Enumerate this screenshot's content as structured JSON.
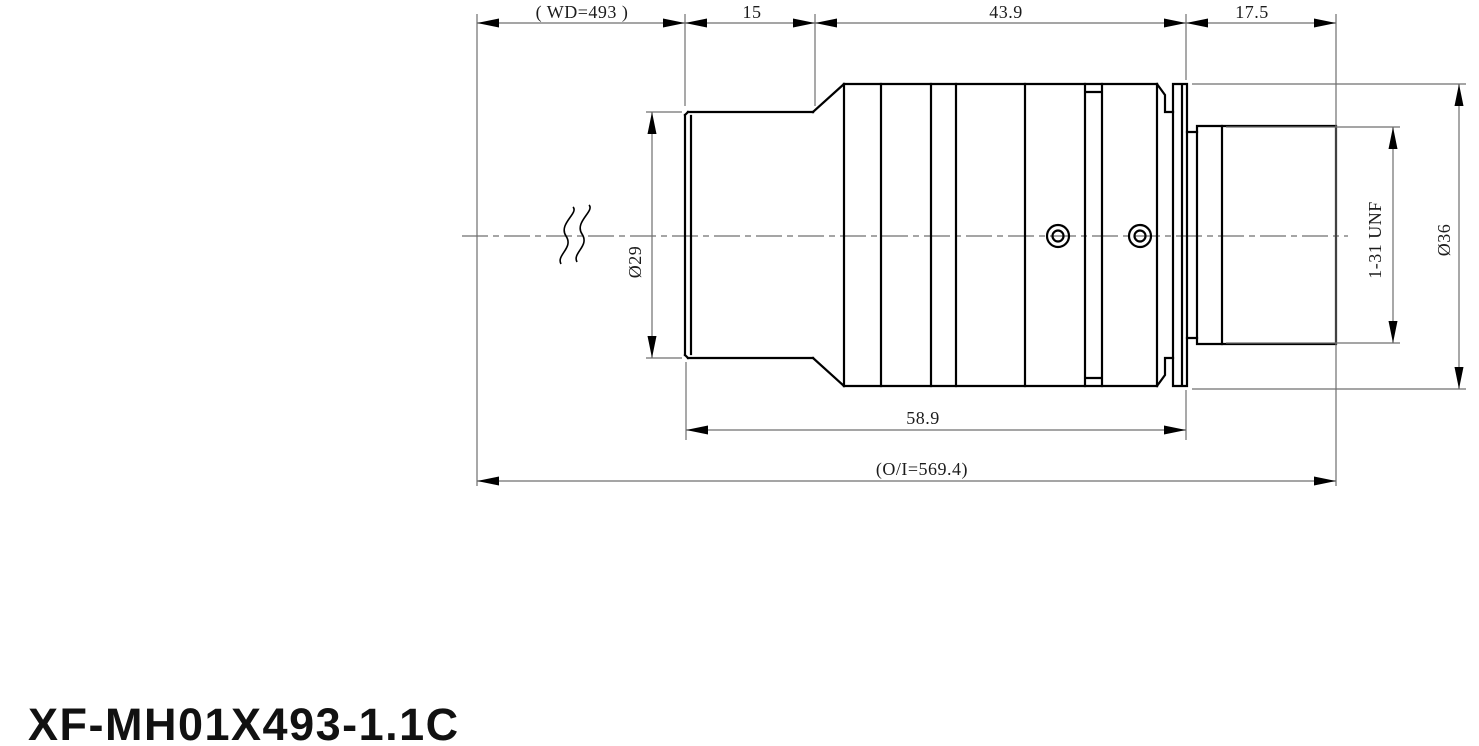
{
  "drawing_title": "XF-MH01X493-1.1C",
  "dimensions": {
    "working_distance": "( WD=493 )",
    "front_length": "15",
    "mid_length": "43.9",
    "rear_length": "17.5",
    "body_length": "58.9",
    "object_image_distance": "(O/I=569.4)",
    "front_diameter": "Ø29",
    "mount_thread": "1-31 UNF",
    "body_diameter": "Ø36"
  },
  "colors": {
    "outline": "#000000",
    "dimension_lines": "#6f6f6f",
    "background": "#ffffff"
  }
}
